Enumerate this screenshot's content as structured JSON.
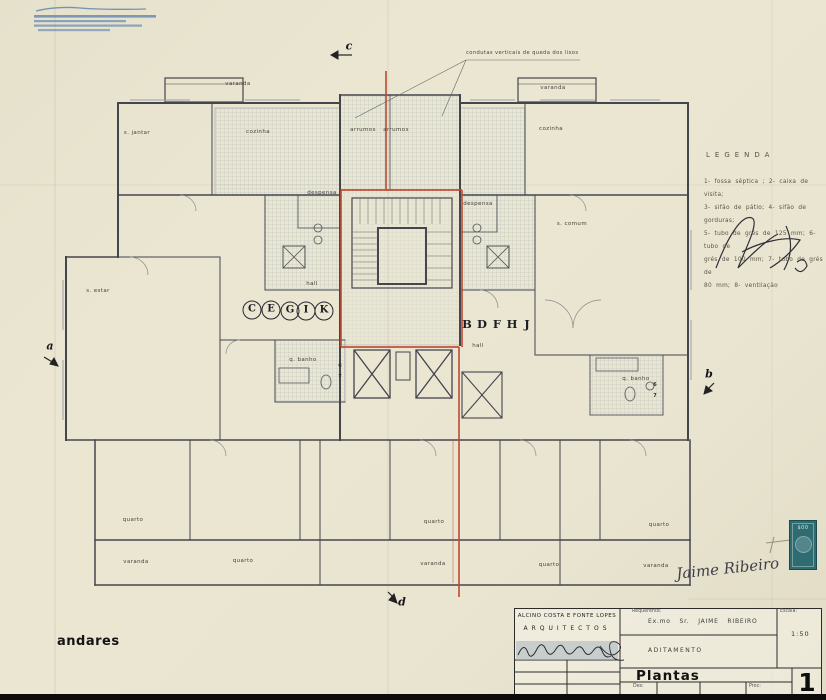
{
  "colors": {
    "paper": "#e9e5d1",
    "line": "#45454e",
    "red": "#c04a32",
    "hatch": "#b3bdbd",
    "stamp_teal": "#2e6c71",
    "stamp_blue": "#4d79ae"
  },
  "plan": {
    "annotation_top": "condutas verticais de queda dos lixos",
    "unit_left": [
      "C",
      "E",
      "G",
      "I",
      "K"
    ],
    "unit_right": [
      "B",
      "D",
      "F",
      "H",
      "J"
    ],
    "labels": [
      "varanda",
      "varanda",
      "s. jantar",
      "cozinha",
      "cozinha",
      "arrumos",
      "arrumos",
      "despensa",
      "despensa",
      "s. estar",
      "s. comum",
      "hall",
      "hall",
      "q. banho",
      "q. banho",
      "quarto",
      "quarto",
      "quarto",
      "quarto",
      "quarto",
      "varanda",
      "varanda",
      "varanda"
    ],
    "ref_markers": [
      "6",
      "7",
      "6",
      "7"
    ],
    "section_markers": [
      "c",
      "d",
      "a",
      "b"
    ]
  },
  "legend": {
    "title": "LEGENDA",
    "lines": [
      "1- fossa séptica ; 2- caixa de visita;",
      "3- sifão de pátio; 4- sifão de gorduras;",
      "5- tubo de grés de 125 mm; 6- tubo de",
      "grés de 100 mm; 7- tubo de grés de",
      "80 mm; 8- ventilação"
    ]
  },
  "footer_label": "andares",
  "titleblock": {
    "firm": "ALCINO COSTA E FONTE LOPES",
    "firm2": "ARQUITECTOS",
    "requerente_label": "Requerente:",
    "requerente": "Ex.mo Sr. JAIME RIBEIRO",
    "aditamento": "ADITAMENTO",
    "title": "Plantas",
    "des_label": "Des:",
    "proc_label": "Proc:",
    "escala_label": "Escala:",
    "escala": "1:50",
    "sheet_number": "1"
  },
  "revenue_stamp_value": "$00",
  "handwritten_signature": "Jaime Ribeiro"
}
